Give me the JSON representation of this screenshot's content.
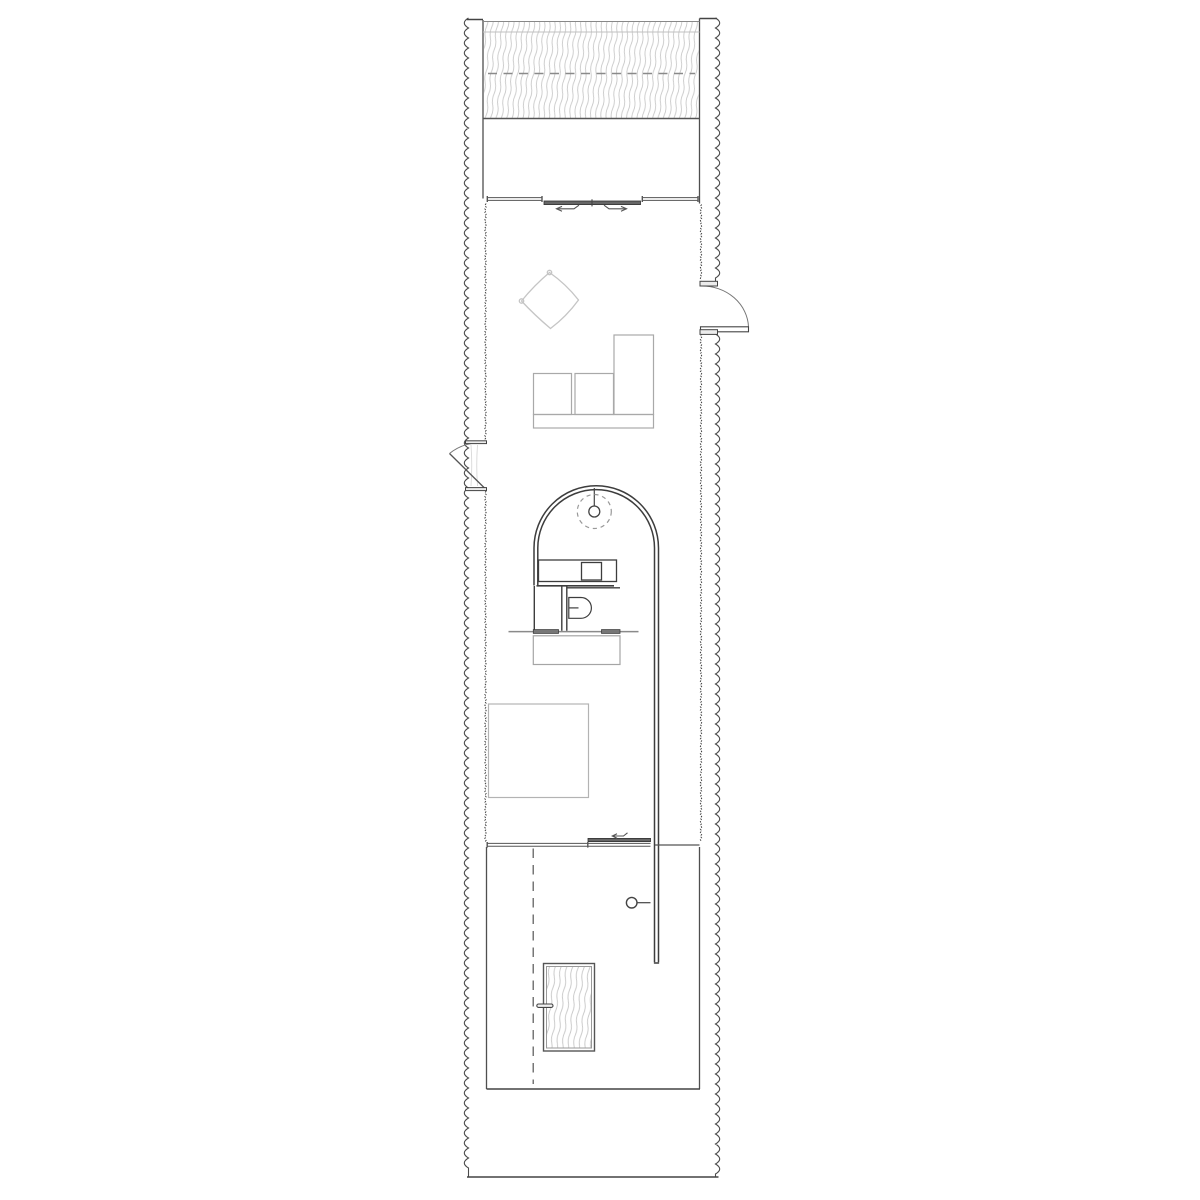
{
  "document_type": "architectural-floor-plan",
  "visible_text": [],
  "colors": {
    "background": "#ffffff",
    "wall_dark": "#3f3f3f",
    "wall_medium": "#5a5a5a",
    "hatch_line": "#c9c9c9",
    "hatch_line_light": "#cfcfcf",
    "dashed_line": "#8a8a8a",
    "furniture_gray": "#aaaaaa",
    "furniture_light_gray": "#c5c5c5",
    "panel_fill": "#666666",
    "tray_fill": "#777777",
    "jamb_fill": "#ececec"
  },
  "elements": {
    "walls": [
      "left-exterior-wavy-wall",
      "right-exterior-wavy-wall",
      "left-interior-edge",
      "right-interior-edge"
    ],
    "zones": [
      "top-deck-hatch-band",
      "upper-room",
      "lower-room",
      "bottom-deck"
    ],
    "doors": [
      "top-sliding-door",
      "right-swing-door",
      "left-swing-door",
      "middle-sliding-door",
      "bottom-hatched-door"
    ],
    "fixtures": [
      "pendant-lamp",
      "arched-partition",
      "kitchen-counter-with-sink",
      "toilet",
      "shelf-with-trays",
      "table",
      "bed",
      "sofa",
      "lounge-diamond-chair",
      "wall-mounted-round-fixture",
      "door-handle"
    ]
  }
}
